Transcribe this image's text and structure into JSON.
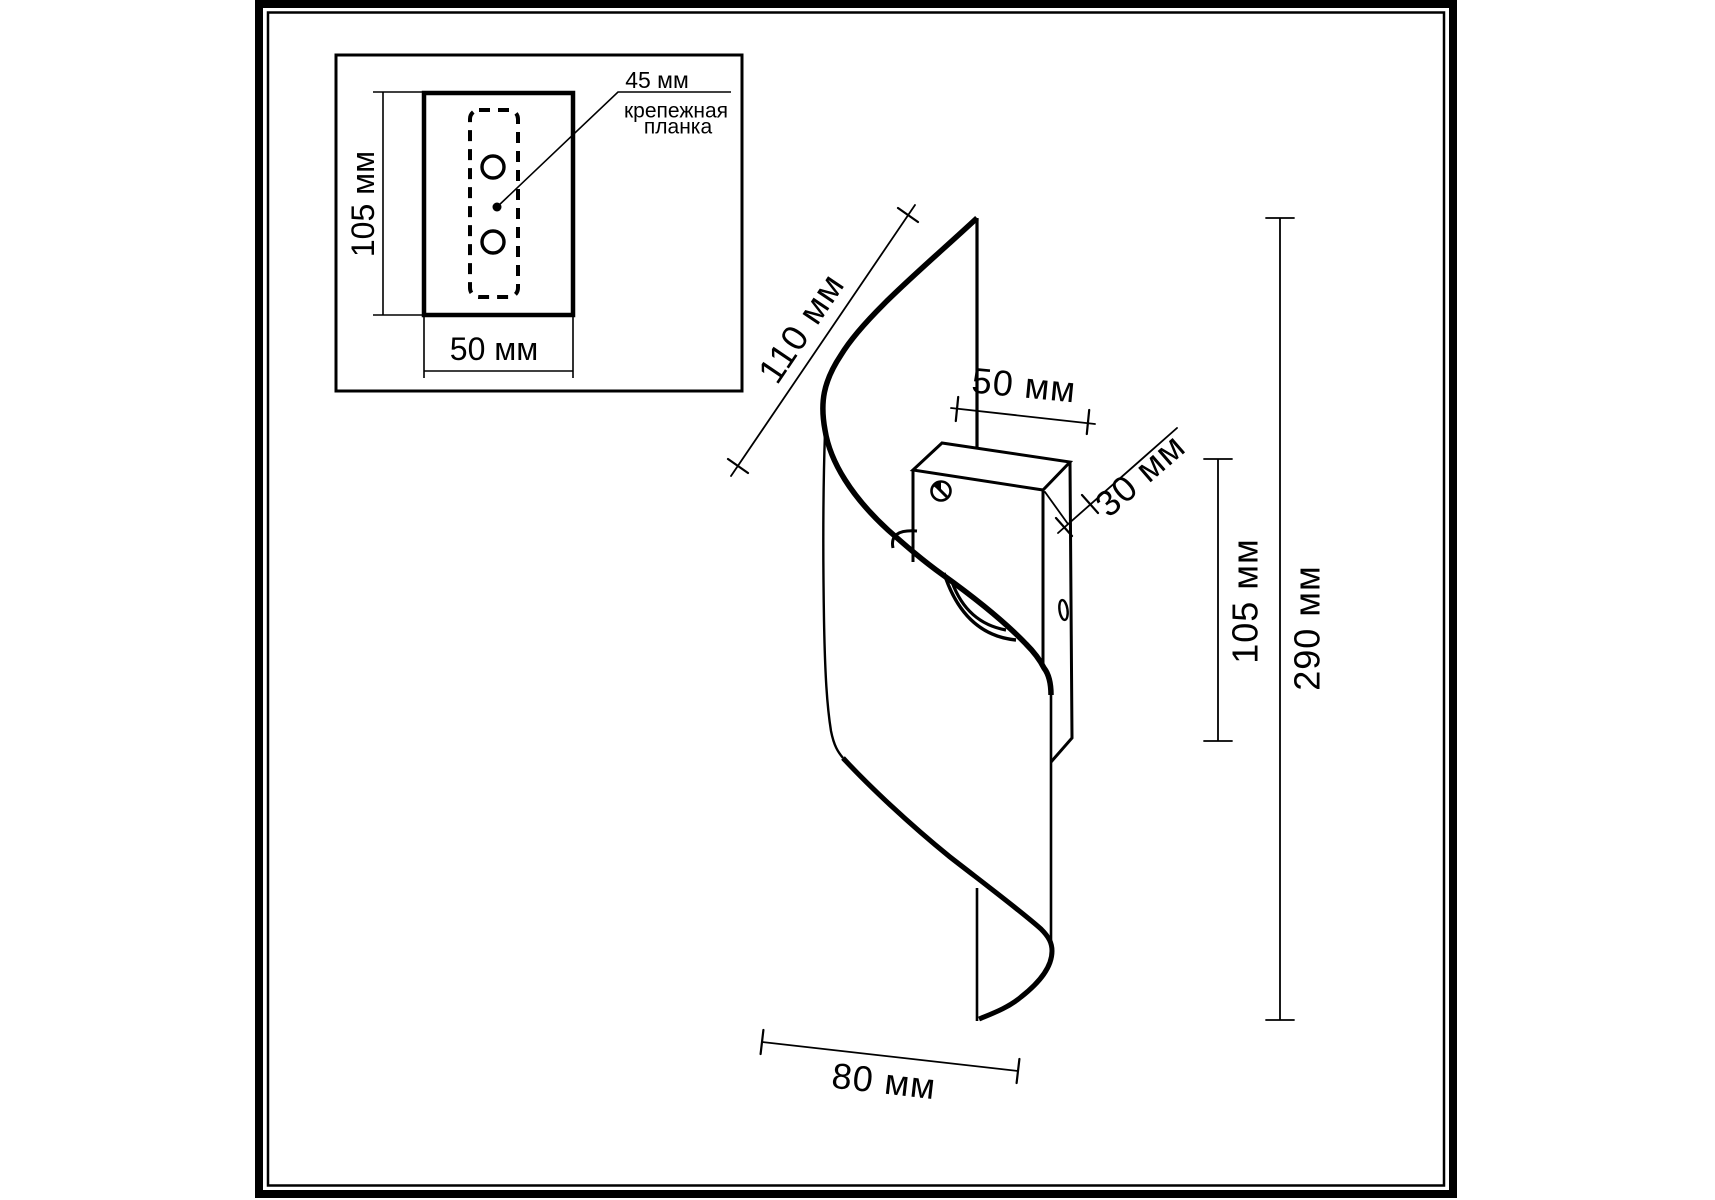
{
  "drawing_type": "wall-sconce-dimension-diagram",
  "colors": {
    "ink": "#000000",
    "paper": "#ffffff"
  },
  "inset": {
    "height_label": "105 мм",
    "width_label": "50 мм",
    "spacing_label": "45 мм",
    "plate_name_line1": "крепежная",
    "plate_name_line2": "планка"
  },
  "main": {
    "shade_edge_label": "110 мм",
    "box_width_label": "50 мм",
    "box_depth_label": "30 мм",
    "box_height_label": "105 мм",
    "overall_height_label": "290 мм",
    "bottom_width_label": "80 мм"
  }
}
